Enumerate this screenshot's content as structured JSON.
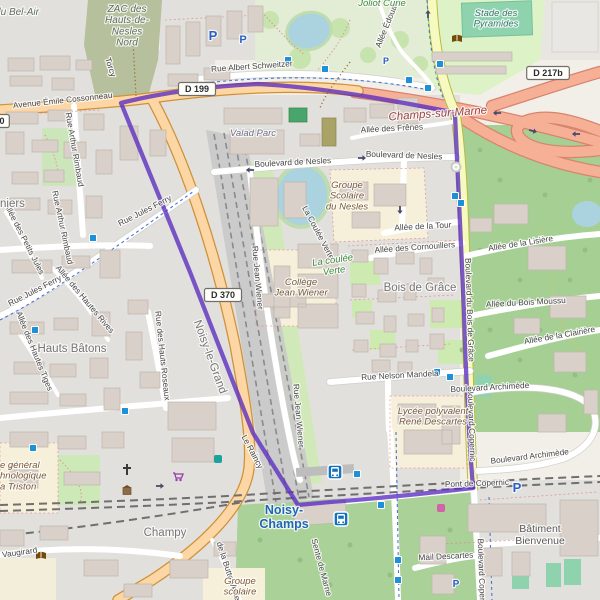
{
  "map": {
    "colors": {
      "boundary_purple": "#5a2bc0",
      "water": "#aad3df",
      "forest_green": "#a6cf94",
      "trunk_road_pink": "#f6b096",
      "primary_road_orange": "#fcd6a4",
      "secondary_road_yellow": "#f7fabf",
      "school_area_beige": "#f6f0da",
      "bus_icon_blue": "#1272bf",
      "parking_blue": "#2a5fc7",
      "station_label_blue": "#1f66b5"
    },
    "place_labels": [
      {
        "text": "du Bel-Air",
        "x": 17,
        "y": 15,
        "cls": "zone"
      },
      {
        "text": "ZAC des\nHauts-de-\nNesles\nNord",
        "x": 127,
        "y": 12,
        "cls": "zone"
      },
      {
        "text": "Joliot Curie",
        "x": 382,
        "y": 6,
        "cls": "park"
      },
      {
        "text": "Stade des\nPyramides",
        "x": 496,
        "y": 16,
        "cls": "leisure"
      },
      {
        "text": "Champs-sur-Marne",
        "x": 438,
        "y": 117,
        "rot": -4,
        "cls": "city"
      },
      {
        "text": "Valad Parc",
        "x": 253,
        "y": 136,
        "cls": "commercial"
      },
      {
        "text": "Groupe\nScolaire\ndu Nesles",
        "x": 347,
        "y": 188,
        "cls": "school"
      },
      {
        "text": "La coulée\nVerte",
        "x": 333,
        "y": 263,
        "rot": -8,
        "cls": "park"
      },
      {
        "text": "Bois de Grâce",
        "x": 420,
        "y": 291,
        "cls": "place"
      },
      {
        "text": "Collège\nJean Wiener",
        "x": 301,
        "y": 285,
        "cls": "school"
      },
      {
        "text": "Hauts Bâtons",
        "x": 72,
        "y": 352,
        "cls": "place"
      },
      {
        "text": "Noisy-le-Grand",
        "x": 207,
        "y": 358,
        "rot": 70,
        "cls": "place"
      },
      {
        "text": "niers",
        "x": 0,
        "y": 207,
        "cls": "place",
        "anchor": "start"
      },
      {
        "text": "Champy",
        "x": 165,
        "y": 536,
        "cls": "place"
      },
      {
        "text": "Noisy-\nChamps",
        "x": 284,
        "y": 514,
        "cls": "station"
      },
      {
        "text": "Bâtiment\nBienvenue",
        "x": 540,
        "y": 532,
        "cls": "building-label"
      },
      {
        "text": "e général\nhnologique\na Triston",
        "x": 0,
        "y": 468,
        "cls": "school",
        "anchor": "start"
      },
      {
        "text": "Lycée polyvalent\nRené Descartes",
        "x": 433,
        "y": 414,
        "cls": "school"
      },
      {
        "text": "Groupe\nscolaire",
        "x": 240,
        "y": 584,
        "cls": "school"
      }
    ],
    "road_labels": [
      {
        "text": "Avenue Émile Cossonneau",
        "x": 63,
        "y": 103,
        "rot": -6
      },
      {
        "text": "Rue Albert Schweitzer",
        "x": 252,
        "y": 69,
        "rot": -4
      },
      {
        "text": "Torcy",
        "x": 108,
        "y": 68,
        "rot": 72
      },
      {
        "text": "Rue Arthur Rimbaud",
        "x": 72,
        "y": 150,
        "rot": 80
      },
      {
        "text": "Rue Arthur Rimbaud",
        "x": 60,
        "y": 228,
        "rot": 78
      },
      {
        "text": "Allée des Petits Jules",
        "x": 22,
        "y": 240,
        "rot": 63
      },
      {
        "text": "Rue Jules Ferry",
        "x": 146,
        "y": 213,
        "rot": -27
      },
      {
        "text": "Rue Jules Ferry",
        "x": 36,
        "y": 293,
        "rot": -27
      },
      {
        "text": "Allée des Hautes Rives",
        "x": 83,
        "y": 301,
        "rot": 50
      },
      {
        "text": "Allée des Hautes Tiges",
        "x": 32,
        "y": 352,
        "rot": 68
      },
      {
        "text": "Rue des Hauts Roseaux",
        "x": 160,
        "y": 356,
        "rot": 84
      },
      {
        "text": "Boulevard de Nesles",
        "x": 293,
        "y": 165,
        "rot": -3
      },
      {
        "text": "Boulevard de Nesles",
        "x": 404,
        "y": 158,
        "rot": 2
      },
      {
        "text": "Allée des Frênes",
        "x": 392,
        "y": 131,
        "rot": -3
      },
      {
        "text": "Allée Édouard",
        "x": 390,
        "y": 24,
        "rot": -68
      },
      {
        "text": "Allée de la Tour",
        "x": 423,
        "y": 229,
        "rot": -3
      },
      {
        "text": "Allée des Cornouillers",
        "x": 415,
        "y": 250,
        "rot": -4
      },
      {
        "text": "Allée de la Lisière",
        "x": 521,
        "y": 246,
        "rot": -9
      },
      {
        "text": "Allée du Bois Moussu",
        "x": 526,
        "y": 305,
        "rot": -3
      },
      {
        "text": "Allée de la Clairière",
        "x": 560,
        "y": 338,
        "rot": -10
      },
      {
        "text": "Boulevard du Bois de Grâce",
        "x": 467,
        "y": 310,
        "rot": 88
      },
      {
        "text": "Boulevard Copernic",
        "x": 469,
        "y": 425,
        "rot": 88
      },
      {
        "text": "Boulevard Copernic",
        "x": 479,
        "y": 575,
        "rot": 88
      },
      {
        "text": "Rue Nelson Mandela",
        "x": 400,
        "y": 378,
        "rot": -3
      },
      {
        "text": "Boulevard Archimède",
        "x": 490,
        "y": 390,
        "rot": -3
      },
      {
        "text": "Boulevard Archimède",
        "x": 530,
        "y": 459,
        "rot": -7
      },
      {
        "text": "Pont de Copernic",
        "x": 477,
        "y": 486,
        "rot": -2
      },
      {
        "text": "Mail Descartes",
        "x": 446,
        "y": 559,
        "rot": -3
      },
      {
        "text": "Rue Jean Wiener",
        "x": 255,
        "y": 278,
        "rot": 85
      },
      {
        "text": "Rue Jean Wiener",
        "x": 296,
        "y": 416,
        "rot": 85
      },
      {
        "text": "La Coulée Verte",
        "x": 316,
        "y": 234,
        "rot": 62
      },
      {
        "text": "Le Raincy",
        "x": 250,
        "y": 453,
        "rot": 62
      },
      {
        "text": "Sente de Marne",
        "x": 319,
        "y": 568,
        "rot": 75
      },
      {
        "text": "de la Butte Verte",
        "x": 226,
        "y": 572,
        "rot": 72
      },
      {
        "text": "Vaugirard",
        "x": 20,
        "y": 555,
        "rot": -8
      }
    ],
    "route_shields": [
      {
        "text": "D 199",
        "x": 197,
        "y": 89
      },
      {
        "text": "D 370",
        "x": 223,
        "y": 295
      },
      {
        "text": "D 217b",
        "x": 548,
        "y": 73
      },
      {
        "text": "0",
        "x": 2,
        "y": 121
      }
    ],
    "parking_icons": [
      {
        "x": 213,
        "y": 40,
        "s": 13
      },
      {
        "x": 243,
        "y": 43,
        "s": 11
      },
      {
        "x": 386,
        "y": 64,
        "s": 9
      },
      {
        "x": 517,
        "y": 492,
        "s": 13
      },
      {
        "x": 456,
        "y": 587,
        "s": 10
      }
    ],
    "bus_stops": [
      [
        288,
        60
      ],
      [
        325,
        69
      ],
      [
        409,
        80
      ],
      [
        440,
        64
      ],
      [
        428,
        88
      ],
      [
        455,
        196
      ],
      [
        461,
        203
      ],
      [
        437,
        372
      ],
      [
        450,
        377
      ],
      [
        93,
        238
      ],
      [
        35,
        330
      ],
      [
        33,
        448
      ],
      [
        125,
        411
      ],
      [
        357,
        474
      ],
      [
        381,
        505
      ],
      [
        398,
        560
      ],
      [
        398,
        580
      ]
    ],
    "bus_stations": [
      [
        335,
        472
      ],
      [
        341,
        519
      ]
    ],
    "poi_icons": [
      {
        "type": "library",
        "x": 457,
        "y": 39
      },
      {
        "type": "library",
        "x": 41,
        "y": 556
      },
      {
        "type": "church",
        "x": 127,
        "y": 470
      },
      {
        "type": "shrine",
        "x": 127,
        "y": 491
      },
      {
        "type": "supermarket-cart",
        "x": 178,
        "y": 477
      },
      {
        "type": "shop-pink",
        "x": 441,
        "y": 508
      },
      {
        "type": "recycle-teal",
        "x": 218,
        "y": 459
      }
    ],
    "oneway_arrows": [
      [
        250,
        170,
        180
      ],
      [
        362,
        158,
        0
      ],
      [
        400,
        210,
        90
      ],
      [
        428,
        14,
        -90
      ],
      [
        497,
        113,
        180
      ],
      [
        533,
        131,
        15
      ],
      [
        576,
        134,
        180
      ],
      [
        160,
        486,
        0
      ],
      [
        12,
        466,
        -40
      ]
    ],
    "mini_roundabout": {
      "x": 456,
      "y": 167
    }
  }
}
